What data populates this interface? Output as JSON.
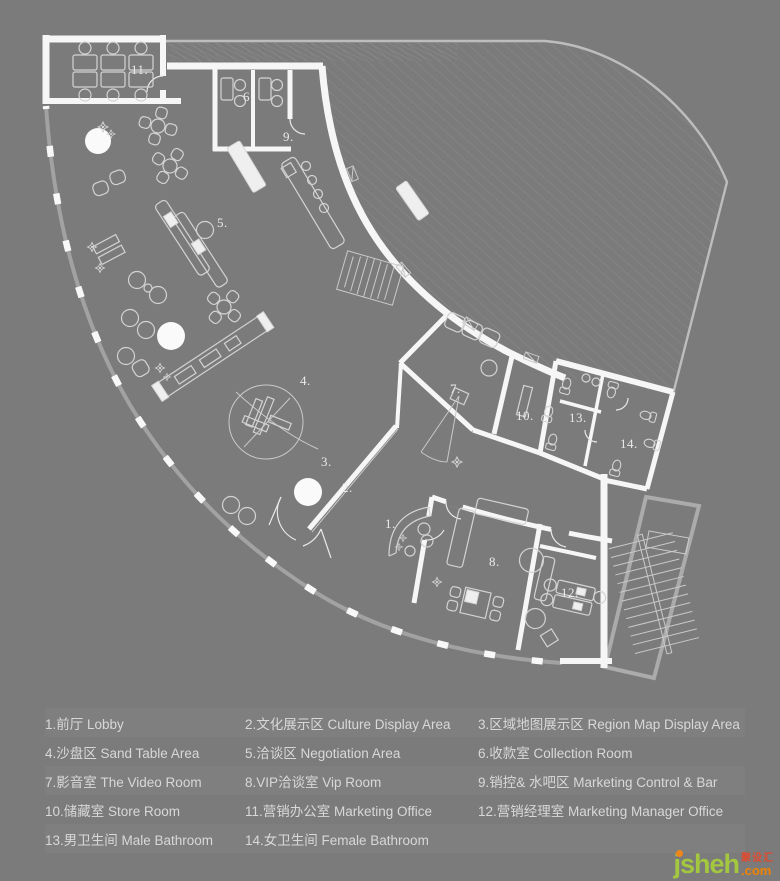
{
  "page": {
    "background": "#7b7b7b"
  },
  "plan": {
    "room_labels": {
      "r1": "1.",
      "r2": "2.",
      "r3": "3.",
      "r4": "4.",
      "r5": "5.",
      "r6": "6.",
      "r7": "7.",
      "r8": "8.",
      "r9": "9.",
      "r10": "10.",
      "r11": "11.",
      "r12": "12.",
      "r13": "13.",
      "r14": "14."
    }
  },
  "legend": {
    "items": [
      "1.前厅  Lobby",
      "2.文化展示区  Culture Display Area",
      "3.区域地图展示区  Region Map Display Area",
      "4.沙盘区 Sand Table Area",
      "5.洽谈区  Negotiation Area",
      "6.收款室  Collection Room",
      "7.影音室 The Video Room",
      "8.VIP洽谈室 Vip Room",
      "9.销控& 水吧区 Marketing Control & Bar",
      "10.储藏室 Store Room",
      "11.营销办公室 Marketing Office",
      "12.营销经理室 Marketing Manager Office",
      "13.男卫生间  Male Bathroom",
      "14.女卫生间 Female Bathroom"
    ]
  },
  "watermark": {
    "name": "jsheh",
    "zh": "聚设汇",
    "tld": ".com"
  },
  "colors": {
    "background": "#7b7b7b",
    "wall": "#f6f6f6",
    "furniture_line": "#d3d3d3",
    "site_line": "#bdbdbd",
    "legend_text": "#d8d8d8",
    "watermark_green": "#a3c73e",
    "watermark_orange": "#ef8200",
    "watermark_red": "#e04a2e"
  }
}
